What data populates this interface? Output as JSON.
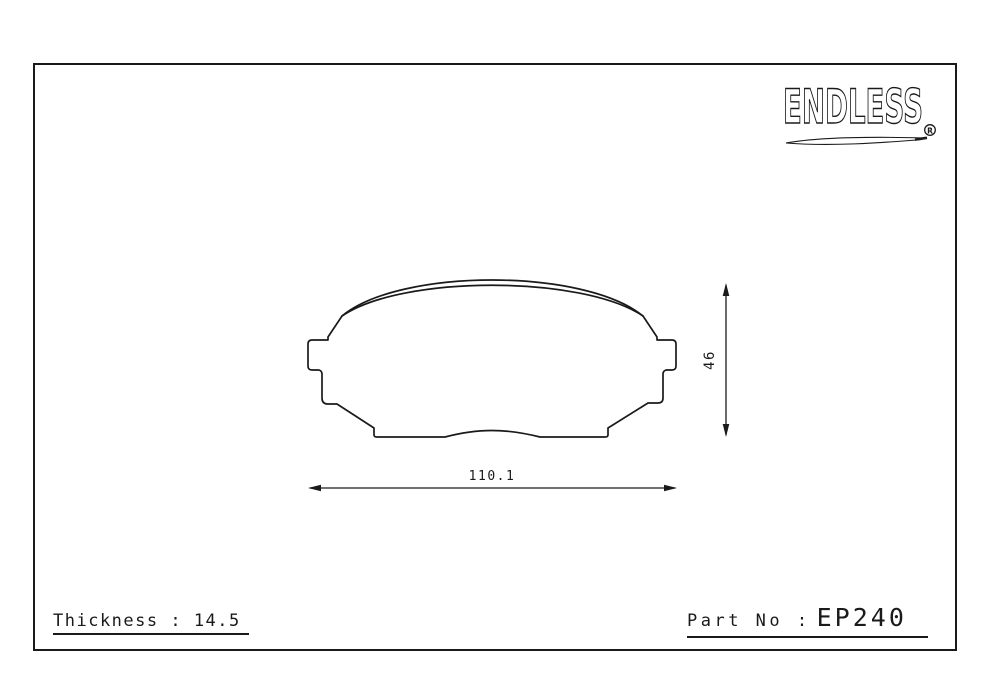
{
  "colors": {
    "ink": "#1a1a1a",
    "paper": "#ffffff"
  },
  "logo": {
    "name": "ENDLESS",
    "registered": "R"
  },
  "dimensions": {
    "width": "110.1",
    "height": "46"
  },
  "footer": {
    "thickness": "Thickness : 14.5",
    "part_no_label": "Part No :",
    "part_no_value": "EP240"
  }
}
